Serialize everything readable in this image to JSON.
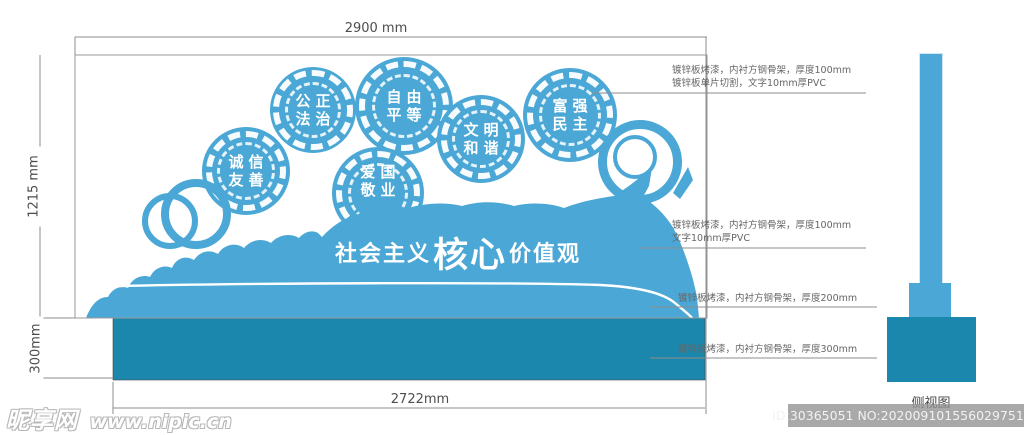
{
  "drawing": {
    "banner": {
      "prefix": "社会主义",
      "core": "核心",
      "suffix": "价值观"
    },
    "medallions": [
      {
        "line1": "诚信",
        "line2": "友善"
      },
      {
        "line1": "公正",
        "line2": "法治"
      },
      {
        "line1": "自由",
        "line2": "平等"
      },
      {
        "line1": "爱国",
        "line2": "敬业"
      },
      {
        "line1": "文明",
        "line2": "和谐"
      },
      {
        "line1": "富强",
        "line2": "民主"
      }
    ],
    "dimensions": {
      "top": "2900 mm",
      "left": "1215 mm",
      "left_lower": "300mm",
      "bottom": "2722mm"
    },
    "annotations": [
      {
        "line1": "镀锌板烤漆，内衬方钢骨架，厚度100mm",
        "line2": "镀锌板单片切割，文字10mm厚PVC"
      },
      {
        "line1": "镀锌板烤漆，内衬方钢骨架，厚度100mm",
        "line2": "文字10mm厚PVC"
      },
      {
        "line1": "镀锌板烤漆，内衬方钢骨架，厚度200mm",
        "line2": ""
      },
      {
        "line1": "镀锌板烤漆，内衬方钢骨架，厚度300mm",
        "line2": ""
      }
    ],
    "side_view_label": "侧视图"
  },
  "watermarks": {
    "site_name": "昵享网",
    "site_url": "www.nipic.cn",
    "id_text": "ID:30365051 NO:20200910155602975192"
  },
  "colors": {
    "main_blue": "#4BA7D5",
    "dark_teal": "#1B87AC",
    "line_gray": "#8C8C8C",
    "text_gray": "#4D4D4D",
    "annotation_gray": "#666666"
  }
}
